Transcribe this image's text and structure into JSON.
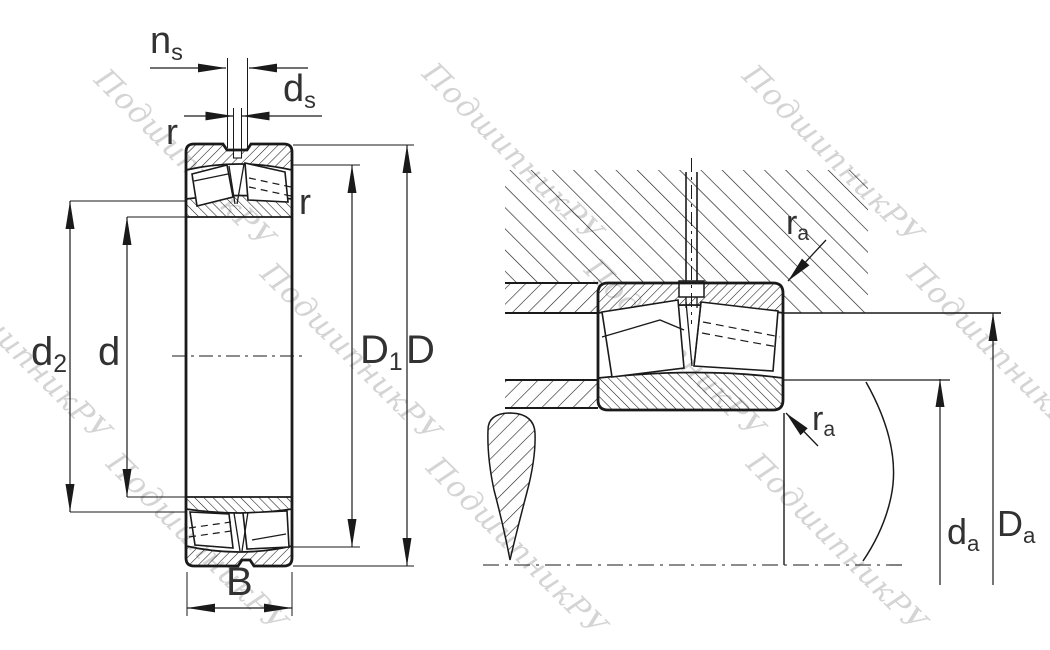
{
  "watermark": {
    "text": "ПодшипникРУ"
  },
  "colors": {
    "line": "#1a1a1a",
    "label": "#323232",
    "watermark": "#c6c6c6",
    "background": "#ffffff"
  },
  "views": {
    "left": "bearing-cross-section",
    "right": "bearing-mounted-in-housing-on-shaft"
  },
  "labels": {
    "ns": {
      "base": "n",
      "sub": "s"
    },
    "ds": {
      "base": "d",
      "sub": "s"
    },
    "r_top": "r",
    "r_right": "r",
    "d2": {
      "base": "d",
      "sub": "2"
    },
    "d": "d",
    "D1": {
      "base": "D",
      "sub": "1"
    },
    "D": "D",
    "B": "B",
    "ra_upper": {
      "base": "r",
      "sub": "a"
    },
    "ra_lower": {
      "base": "r",
      "sub": "a"
    },
    "da": {
      "base": "d",
      "sub": "a"
    },
    "Da": {
      "base": "D",
      "sub": "a"
    }
  }
}
